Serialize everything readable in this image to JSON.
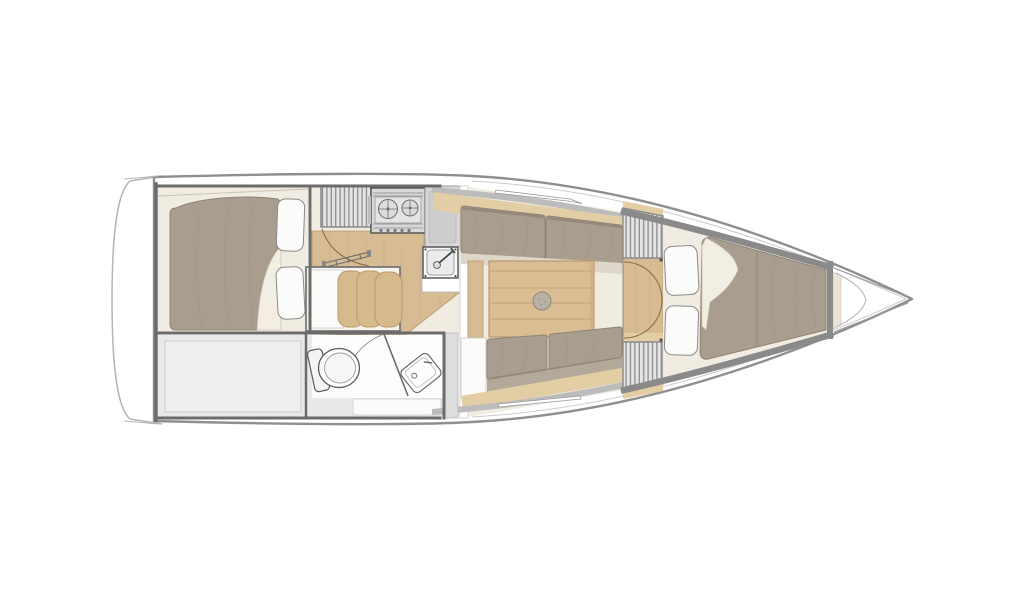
{
  "meta": {
    "title": "Sailboat interior layout plan",
    "aria_label": "Top-down interior floor plan of a sailing yacht, bow pointing right",
    "view": "top-down",
    "bow_direction": "right"
  },
  "palette": {
    "white": "#ffffff",
    "cream": "#f1ece2",
    "cream_edge": "#cac3b4",
    "sheet": "#f3eee4",
    "pillow": "#fbfbfa",
    "wood": "#d7bb93",
    "wood_dark": "#b9976a",
    "wood_light": "#e3cda4",
    "upholstery_taupe": "#a89d8e",
    "upholstery_dark": "#8e8476",
    "backrest_strip": "#b3a999",
    "seat_strip": "#ddd6c9",
    "cushion_tan": "#d6ba8e",
    "gray_fill": "#e9e9e9",
    "gray_fill_dark": "#dddddd",
    "inner_gray": "#efefef",
    "steel": "#d8d8d8",
    "steel_dark": "#cdcdcd",
    "table_circle": "#b7b0a3",
    "hull_outline": "#8f8f8f",
    "hull_outline_light": "#b5b5b5",
    "wall_dark": "#6b6b6b",
    "wall_mid": "#8a8a8a",
    "wall_band": "#bcbcbc",
    "line_thin": "#9a9a9a",
    "line_light": "#cccccc",
    "fixture_outline": "#4e4e4e",
    "hatch_bg": "#e4e4e4",
    "hatch_line": "#8c8c8c",
    "arc_line": "#8a6b45"
  },
  "regions": {
    "aft_cabin": "aft-double-cabin",
    "stowage": "aft-stowage-locker",
    "companionway": "companionway-steps",
    "galley": "galley",
    "nav_seat": "bench-seat",
    "head": "head-compartment",
    "saloon": "saloon",
    "fwd_bulkhead": "forward-bulkhead-lockers",
    "v_berth": "forward-v-berth",
    "bow": "bow-anchor-locker"
  }
}
